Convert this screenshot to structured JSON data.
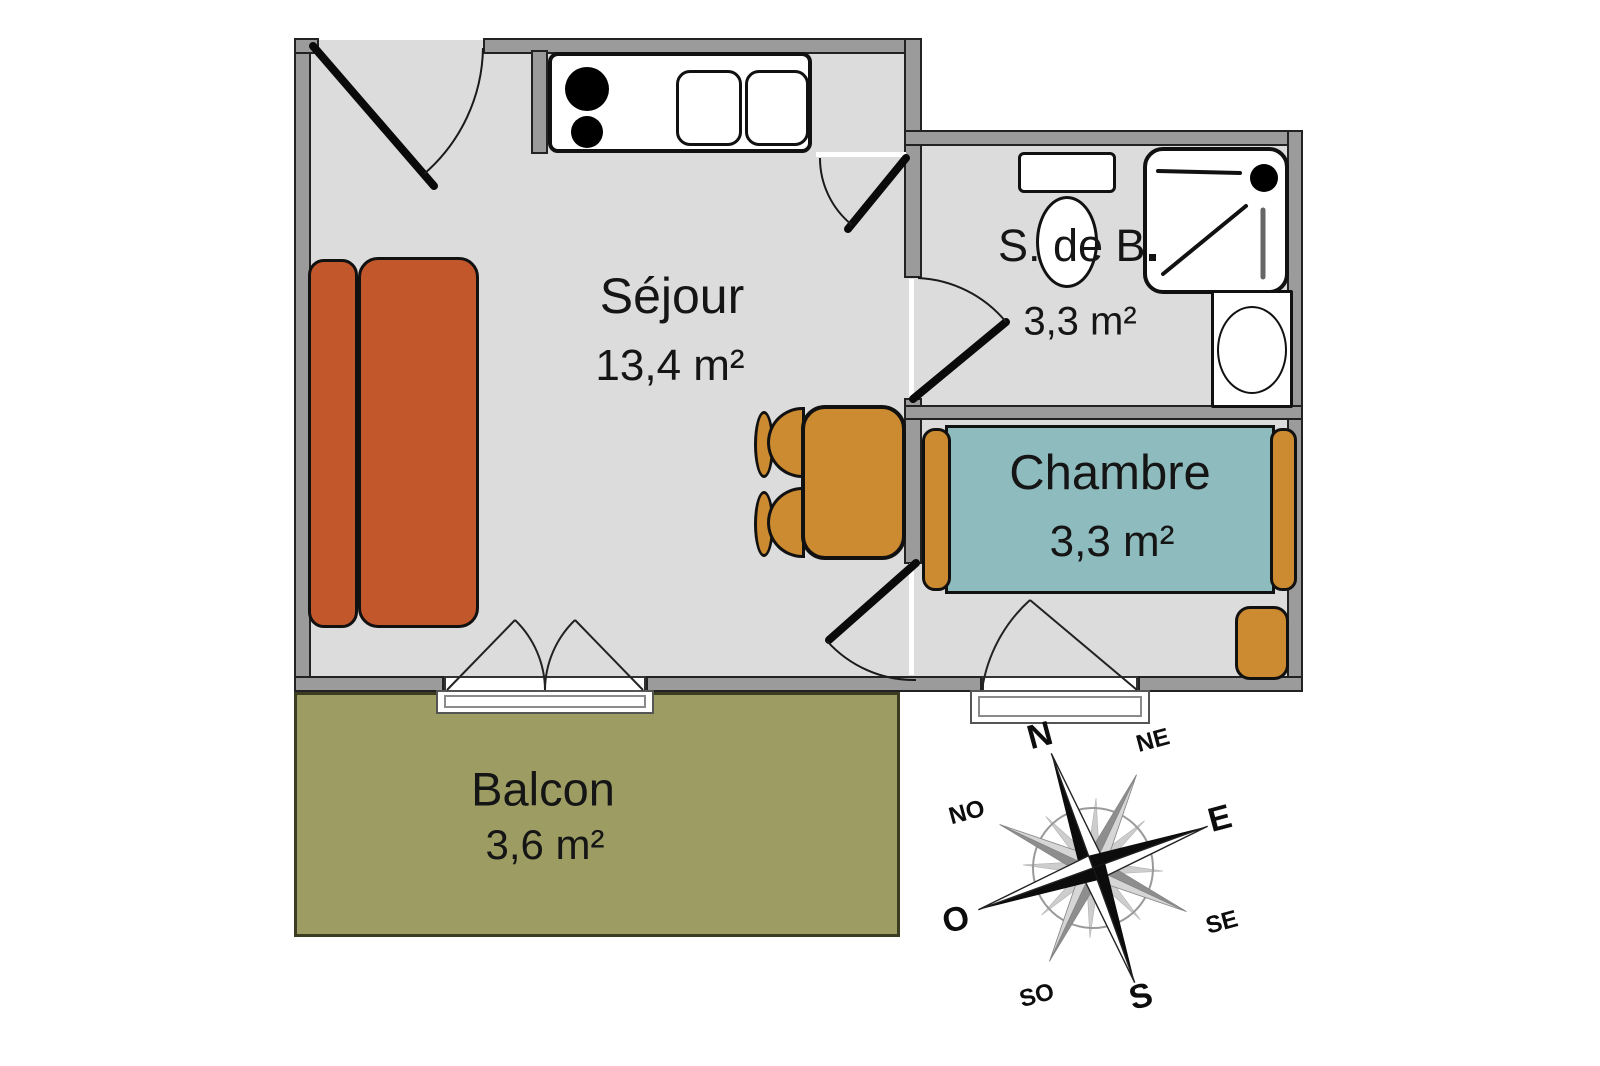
{
  "rooms": {
    "sejour": {
      "name": "Séjour",
      "area": "13,4 m²"
    },
    "bathroom": {
      "name": "S. de B.",
      "area": "3,3 m²"
    },
    "bedroom": {
      "name": "Chambre",
      "area": "3,3 m²"
    },
    "balcony": {
      "name": "Balcon",
      "area": "3,6 m²"
    }
  },
  "compass": {
    "n": "N",
    "ne": "NE",
    "e": "E",
    "se": "SE",
    "s": "S",
    "so": "SO",
    "o": "O",
    "no": "NO"
  },
  "colors": {
    "floor": "#dcdcdc",
    "wall": "#9b9b9b",
    "sofa": "#c2572c",
    "wood": "#cc8b30",
    "bed": "#8ebbbd",
    "balcony": "#9c9c63"
  }
}
